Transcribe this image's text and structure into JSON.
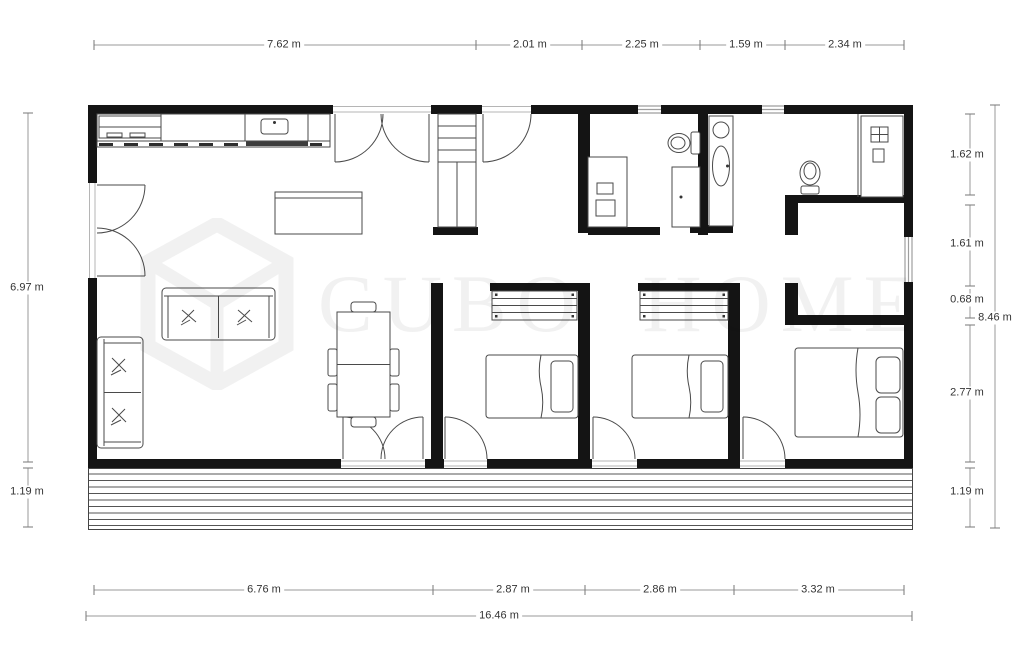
{
  "watermark": {
    "brand": "CUBO HOME"
  },
  "dims": {
    "top": [
      "7.62 m",
      "2.01 m",
      "2.25 m",
      "1.59 m",
      "2.34 m"
    ],
    "bottom": [
      "6.76 m",
      "2.87 m",
      "2.86 m",
      "3.32 m"
    ],
    "total_width": "16.46 m",
    "left": [
      "6.97 m",
      "1.19 m"
    ],
    "right": [
      "1.62 m",
      "1.61 m",
      "0.68 m",
      "2.77 m",
      "1.19 m"
    ],
    "total_height": "8.46 m"
  },
  "colors": {
    "wall": "#141414",
    "furn": "#4a4a4a",
    "win": "#9e9e9e",
    "dim": "#9a9a9a",
    "dimtext": "#333333",
    "watermark": "#111111"
  }
}
